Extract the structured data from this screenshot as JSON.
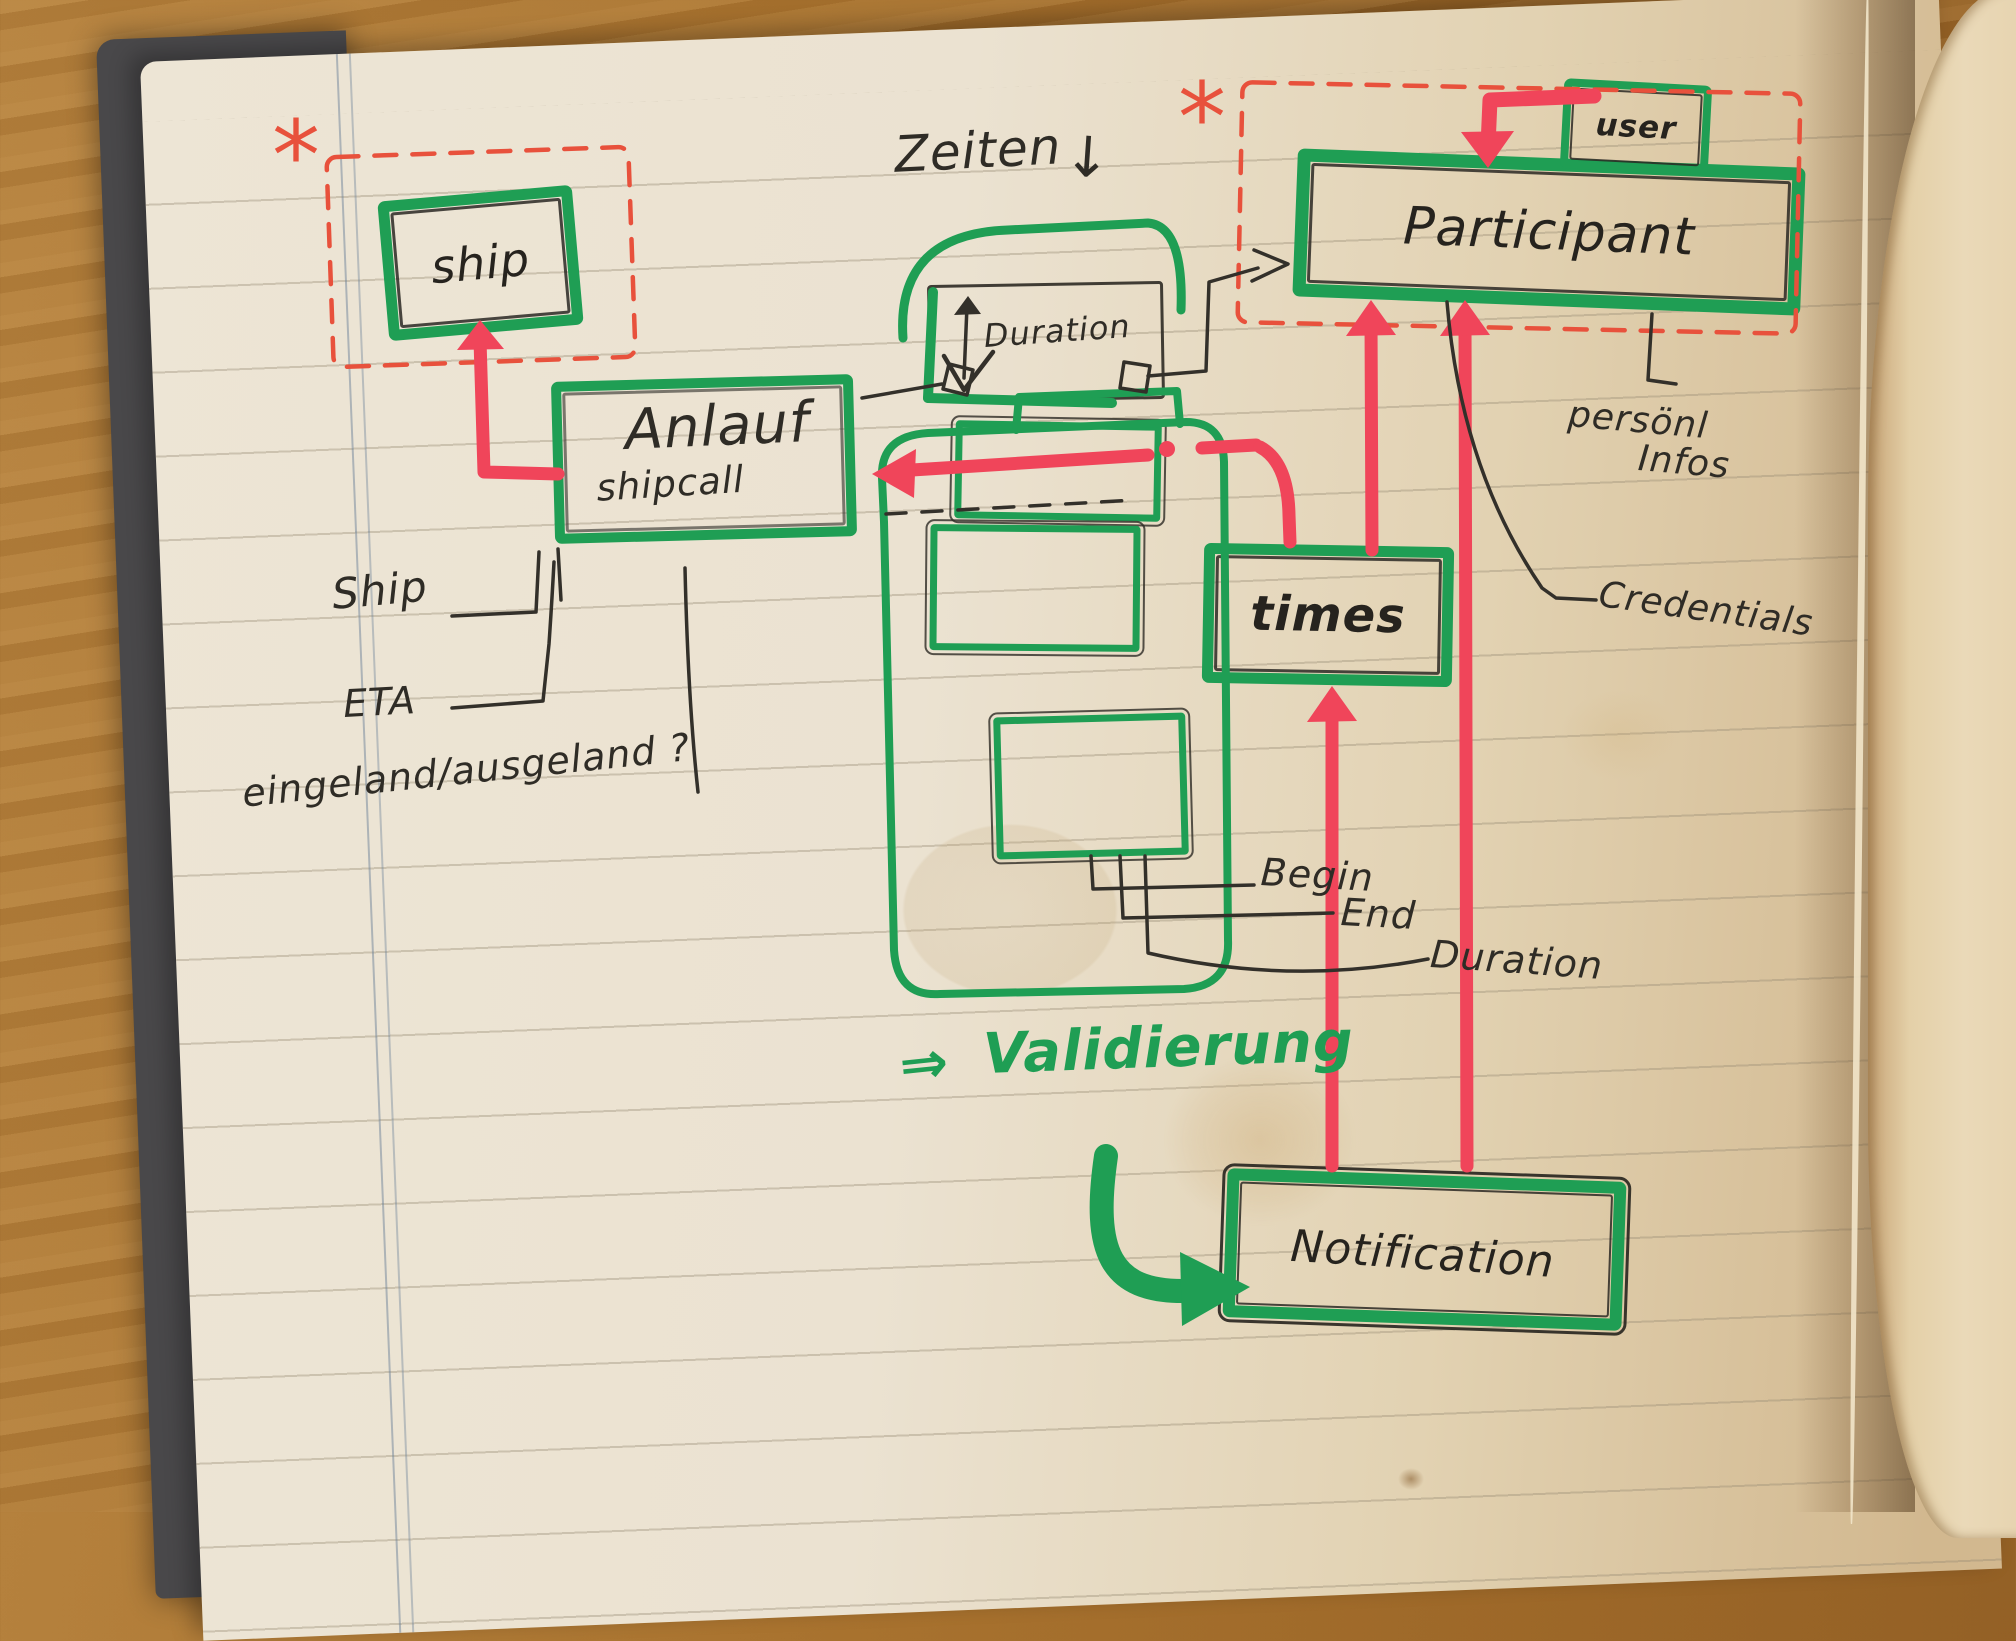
{
  "colors": {
    "green": "#1f9e54",
    "red": "#f0455a",
    "red_dashed": "#e8513c",
    "ink": "#2e2c28"
  },
  "entities": {
    "ship": "ship",
    "anlauf": "Anlauf",
    "shipcall": "shipcall",
    "participant": "Participant",
    "user": "user",
    "times": "times",
    "notification": "Notification",
    "duration_box": "Duration"
  },
  "attributes": {
    "ship": "Ship",
    "eta": "ETA",
    "eingeland": "eingeland/ausgeland ?",
    "begin": "Begin",
    "end": "End",
    "duration": "Duration",
    "personal_line1": "persönl",
    "personal_line2": "Infos",
    "credentials": "Credentials"
  },
  "annotations": {
    "zeiten": "Zeiten",
    "zeiten_arrow": "↓",
    "validierung_arrow": "⇒",
    "validierung": "Validierung",
    "asterisk_ship": "*",
    "asterisk_participant": "*"
  }
}
